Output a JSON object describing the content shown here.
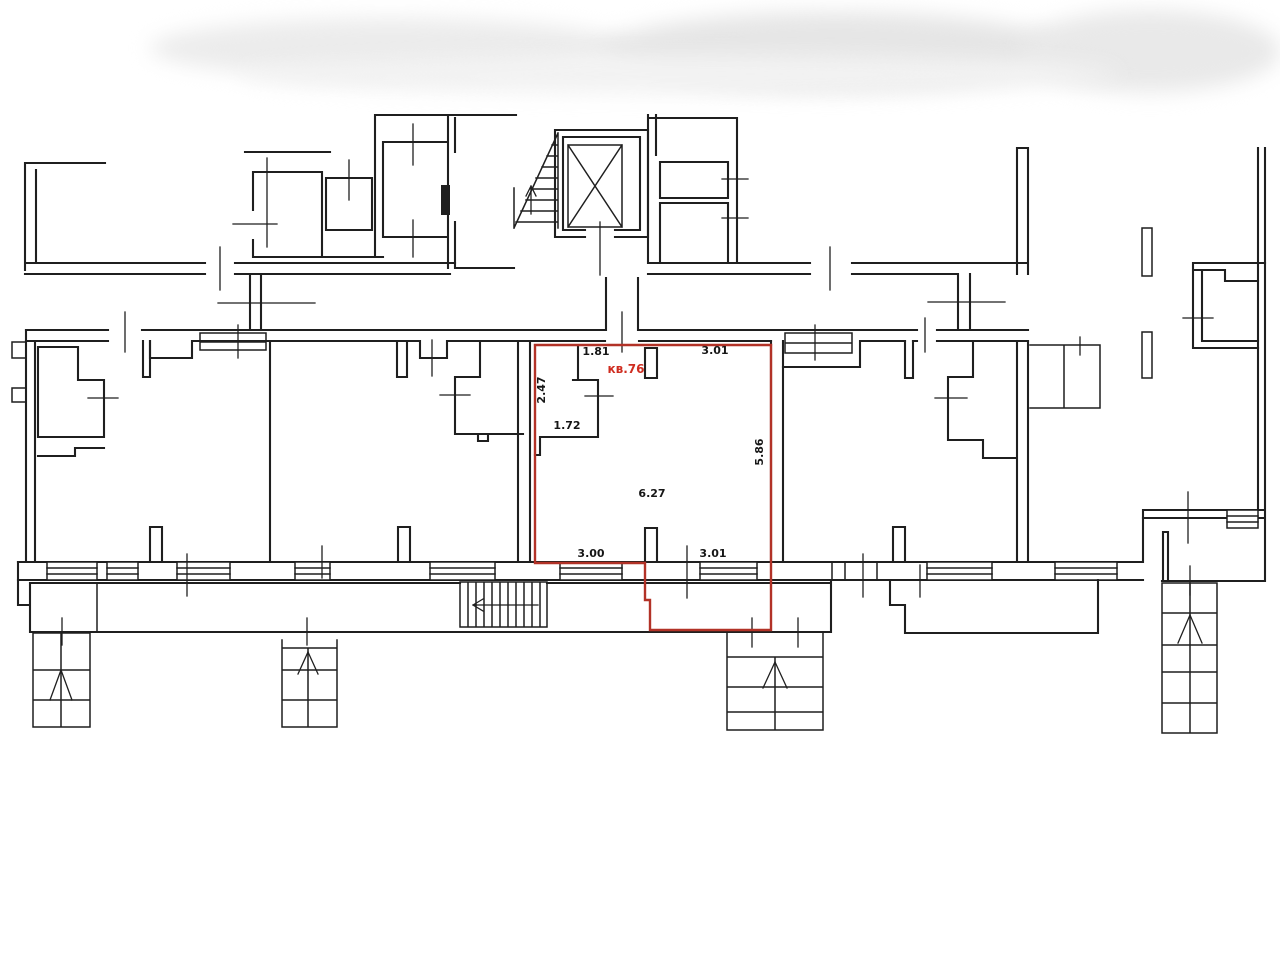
{
  "plan": {
    "title": "floor-plan",
    "unit_label": "кв.76",
    "dimensions": {
      "top_left": "1.81",
      "top_right": "3.01",
      "left_side": "2.47",
      "closet": "1.72",
      "right_side": "5.86",
      "room_width": "6.27",
      "bottom_left": "3.00",
      "bottom_right": "3.01"
    },
    "colors": {
      "wall": "#1f1f1f",
      "highlight": "#b23227",
      "unit_label_color": "#cf2d20",
      "background": "#ffffff"
    }
  }
}
